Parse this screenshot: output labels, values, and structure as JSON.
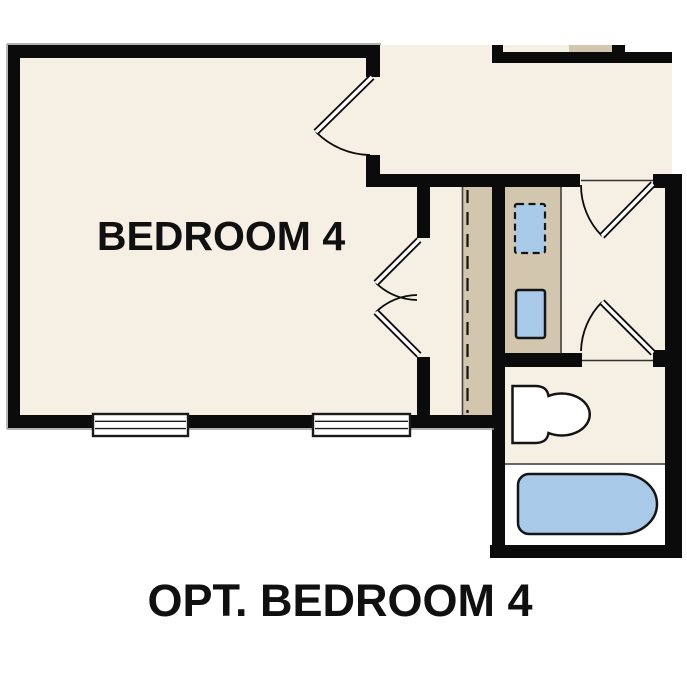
{
  "floor_plan": {
    "room_label": "BEDROOM 4",
    "caption": "OPT. BEDROOM 4",
    "colors": {
      "wall": "#0b0b0b",
      "floor_cream": "#f6efe3",
      "closet_tan": "#d3c6ae",
      "fixture_blue": "#a9c9e9",
      "fixture_white": "#ffffff",
      "outer_outline_gray": "#9a9a9a",
      "background": "#ffffff"
    },
    "fixtures": [
      "washer-optional-dashed",
      "dryer",
      "toilet",
      "bathtub"
    ],
    "features": {
      "windows": 2,
      "swing_doors": 5,
      "dashed_line": "chase / optional wall line"
    }
  }
}
